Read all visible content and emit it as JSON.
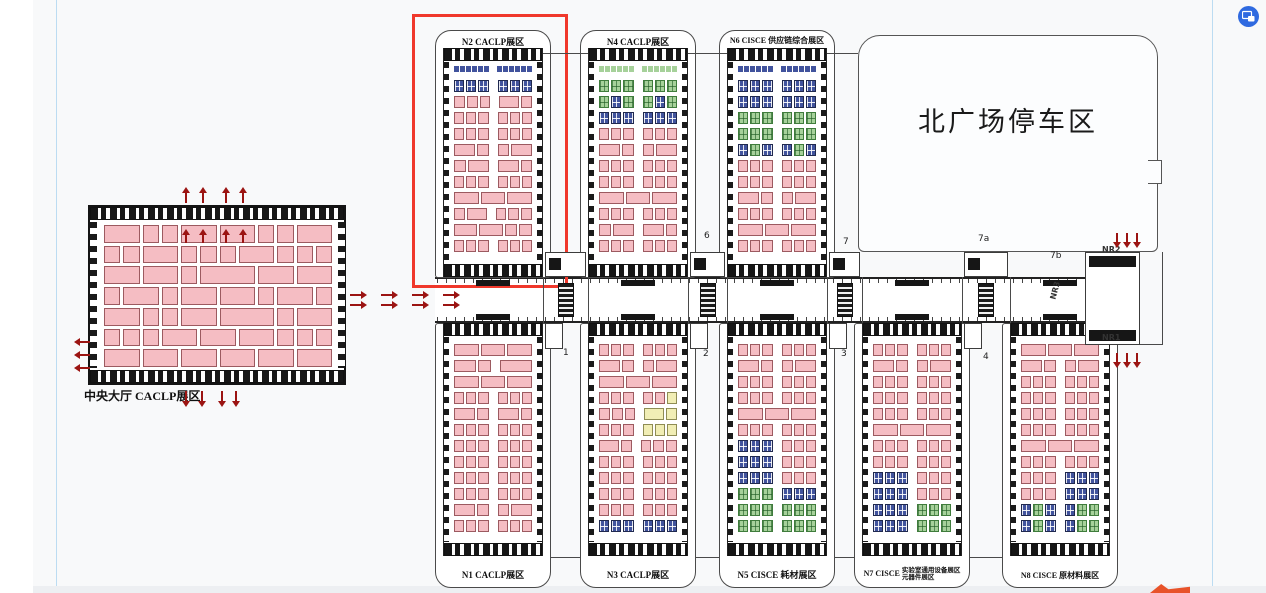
{
  "app": {
    "floating_icon": {
      "name": "picture-in-picture-capture-icon",
      "color": "#2f6ae0"
    }
  },
  "colors": {
    "highlight": "#f0382b",
    "arrow": "#9b1412",
    "booth_pink": "#f5bdc3",
    "booth_blue": "#41539d",
    "booth_green": "#a6d19a",
    "booth_yellow": "#f1eeb5"
  },
  "plan": {
    "highlighted_hall": "N2",
    "central_hall": {
      "label": "中央大厅 CACLP展区",
      "booth_rows": [
        [
          2,
          1,
          1,
          2,
          2,
          1,
          1,
          2
        ],
        [
          1,
          1,
          2,
          1,
          1,
          1,
          2,
          1,
          1,
          1
        ],
        [
          2,
          2,
          1,
          3,
          2,
          2
        ],
        [
          1,
          2,
          1,
          2,
          2,
          1,
          2,
          1
        ],
        [
          2,
          1,
          1,
          2,
          3,
          1,
          2
        ],
        [
          1,
          1,
          1,
          2,
          2,
          2,
          1,
          1,
          1
        ],
        [
          2,
          2,
          2,
          2,
          2,
          2
        ]
      ]
    },
    "parking": {
      "label": "北广场停车区"
    },
    "halls": [
      {
        "id": "N2",
        "row": "top",
        "col": 0,
        "label": "N2 CACLP展区",
        "rows": [
          "S",
          "b1b1b1b1b1b1",
          "p1p1p1p2p1",
          "p1p1p1p1p1p1",
          "p1p1p1p1p1p1",
          "p2p1p1p2",
          "p1p2p2p1",
          "p1p1p1p1p1p1",
          "p2p2p2",
          "p1p2p1p1p1",
          "p2p2p1p1",
          "p1p1p1p1p1p1"
        ]
      },
      {
        "id": "N4",
        "row": "top",
        "col": 1,
        "label": "N4 CACLP展区",
        "rows": [
          "T",
          "g1g1g1g1g1g1",
          "g1b1g1g1b1g1",
          "b1b1b1b1b1b1",
          "p1p1p1p1p1p1",
          "p2p1p1p2",
          "p1p1p1p1p1p1",
          "p1p1p1p1p1p1",
          "p2p2p2",
          "p1p1p1p1p1p1",
          "p1p2p2p1",
          "p1p1p1p1p1p1"
        ]
      },
      {
        "id": "N6",
        "row": "top",
        "col": 2,
        "label": "N6 CISCE 供应链综合展区",
        "rows": [
          "S",
          "b1b1b1b1b1b1",
          "b1b1b1b1b1b1",
          "g1g1g1g1g1g1",
          "g1g1g1g1g1g1",
          "b1g1b1b1g1b1",
          "p1p1p1p1p1p1",
          "p1p1p1p1p1p1",
          "p2p1p1p2",
          "p1p1p1p1p1p1",
          "p2p2p2",
          "p1p1p1p1p1p1"
        ]
      },
      {
        "id": "N1",
        "row": "bottom",
        "col": 0,
        "label": "N1 CACLP展区",
        "rows": [
          "p2p2p2",
          "p2p1p3",
          "p2p2p2",
          "p1p1p1p1p1p1",
          "p2p1p2p1",
          "p1p1p1p1p1p1",
          "p1p1p1p1p1p1",
          "p1p1p1p1p1p1",
          "p1p1p1p1p1p1",
          "p1p1p1p1p1p1",
          "p2p1p1p2",
          "p1p1p1p1p1p1"
        ]
      },
      {
        "id": "N3",
        "row": "bottom",
        "col": 1,
        "label": "N3 CACLP展区",
        "rows": [
          "p1p1p1p1p1p1",
          "p2p1p1p2",
          "p2p2p2",
          "p1p1p1p1p1y1",
          "p1p1p1y2y1",
          "p1p1p1y1y1y1",
          "p2p1p1p1p1",
          "p1p1p1p1p1p1",
          "p1p1p1p1p1p1",
          "p1p1p1p1p1p1",
          "p1p1p1p1p1p1",
          "b1b1b1b1b1b1"
        ]
      },
      {
        "id": "N5",
        "row": "bottom",
        "col": 2,
        "label": "N5 CISCE 耗材展区",
        "rows": [
          "p1p1p1p1p1p1",
          "p2p1p1p2",
          "p1p1p1p1p1p1",
          "p1p1p1p1p1p1",
          "p2p2p2",
          "p1p1p1p1p1p1",
          "b1b1b1p1p1p1",
          "b1b1b1p1p1p1",
          "b1b1b1p1p1p1",
          "g1g1g1b1b1b1",
          "g1g1g1g1g1g1",
          "g1g1g1g1g1g1"
        ]
      },
      {
        "id": "N7",
        "row": "bottom",
        "col": 3,
        "label": "N7 CISCE",
        "label_lines": [
          "实验室通用设备展区",
          "元器件展区"
        ],
        "rows": [
          "p1p1p1p1p1p1",
          "p2p1p1p2",
          "p1p1p1p1p1p1",
          "p1p1p1p1p1p1",
          "p1p1p1p1p1p1",
          "p2p2p2",
          "p1p1p1p1p1p1",
          "p1p1p1p1p1p1",
          "b1b1b1p1p1p1",
          "b1b1b1p1p1p1",
          "b1b1b1g1g1g1",
          "b1b1b1g1g1g1"
        ]
      },
      {
        "id": "N8",
        "row": "bottom",
        "col": 4,
        "label": "N8 CISCE 原材料展区",
        "rows": [
          "p2p2p2",
          "p2p1p1p2",
          "p1p1p1p1p1p1",
          "p1p1p1p1p1p1",
          "p1p1p1p1p1p1",
          "p1p1p1p1p1p1",
          "p2p2p2",
          "p1p1p1p1p1p1",
          "p1p1p1b1b1b1",
          "p1p1p1b1b1b1",
          "b1g1b1b1g1g1",
          "b1g1b1b1g1g1"
        ]
      }
    ],
    "markers": {
      "junctions_top": [
        "6",
        "7",
        "7a",
        "7b"
      ],
      "junctions_bottom": [
        "1",
        "2",
        "3",
        "4"
      ],
      "nr": [
        "NR2",
        "NR3",
        "NR1"
      ]
    }
  }
}
